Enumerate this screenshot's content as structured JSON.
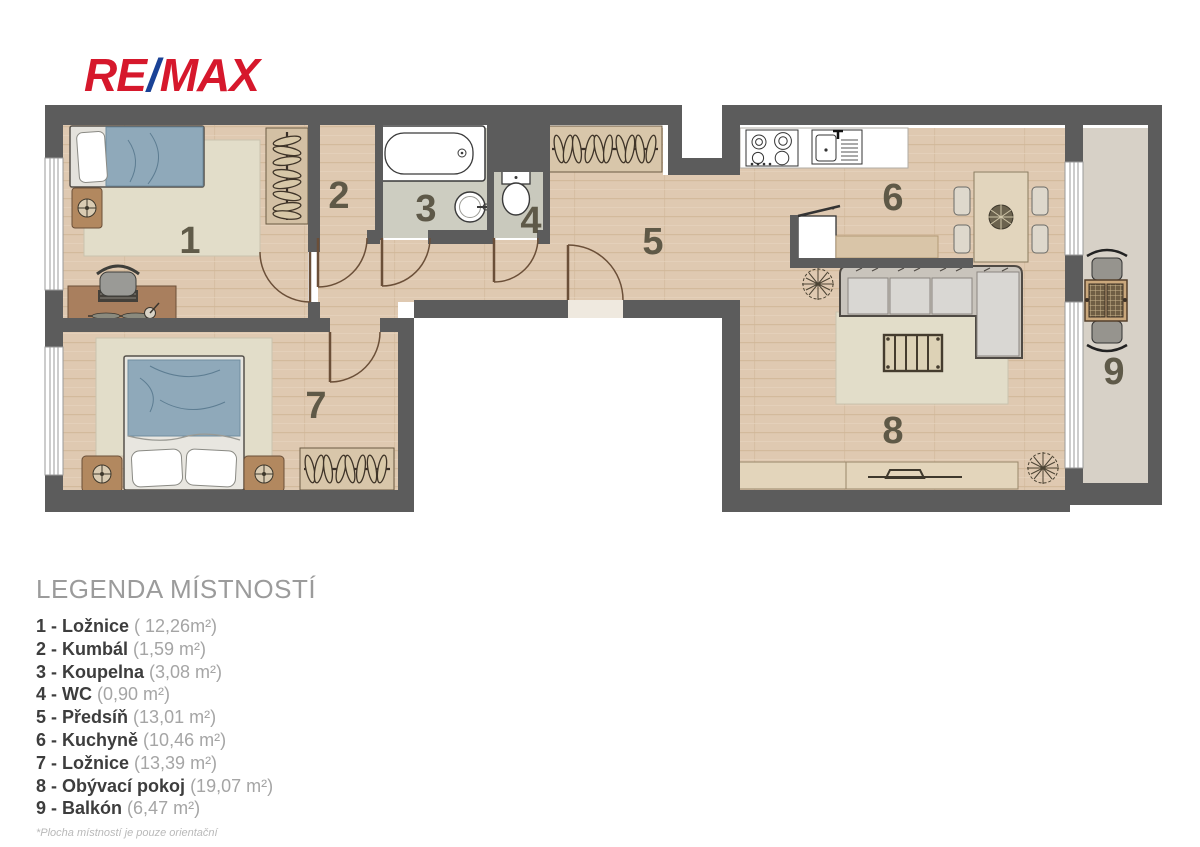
{
  "logo": {
    "re": "RE",
    "slash": "/",
    "max": "MAX"
  },
  "plan": {
    "room_numbers": [
      "1",
      "2",
      "3",
      "4",
      "5",
      "6",
      "7",
      "8",
      "9"
    ]
  },
  "legend": {
    "title": "LEGENDA MÍSTNOSTÍ",
    "items": [
      {
        "label": "1 - Ložnice",
        "area": "( 12,26m²)"
      },
      {
        "label": "2 - Kumbál",
        "area": "(1,59 m²)"
      },
      {
        "label": "3 - Koupelna",
        "area": "(3,08 m²)"
      },
      {
        "label": "4 - WC",
        "area": "(0,90 m²)"
      },
      {
        "label": "5 - Předsíň",
        "area": "(13,01 m²)"
      },
      {
        "label": "6 - Kuchyně",
        "area": "(10,46 m²)"
      },
      {
        "label": "7 - Ložnice",
        "area": "(13,39 m²)"
      },
      {
        "label": "8 - Obývací pokoj",
        "area": "(19,07 m²)"
      },
      {
        "label": "9 - Balkón",
        "area": "(6,47 m²)"
      }
    ],
    "footnote": "*Plocha místností je pouze orientační"
  },
  "colors": {
    "wall": "#5c5c5c",
    "wood_floor": "#dfc9b1",
    "tile_floor": "#cdcdc1",
    "balcony_floor": "#d7d1c7",
    "rug": "#e2ddc9",
    "bed_blue": "#8fa9ba",
    "logo_red": "#d6182c",
    "logo_blue": "#1a4296"
  }
}
